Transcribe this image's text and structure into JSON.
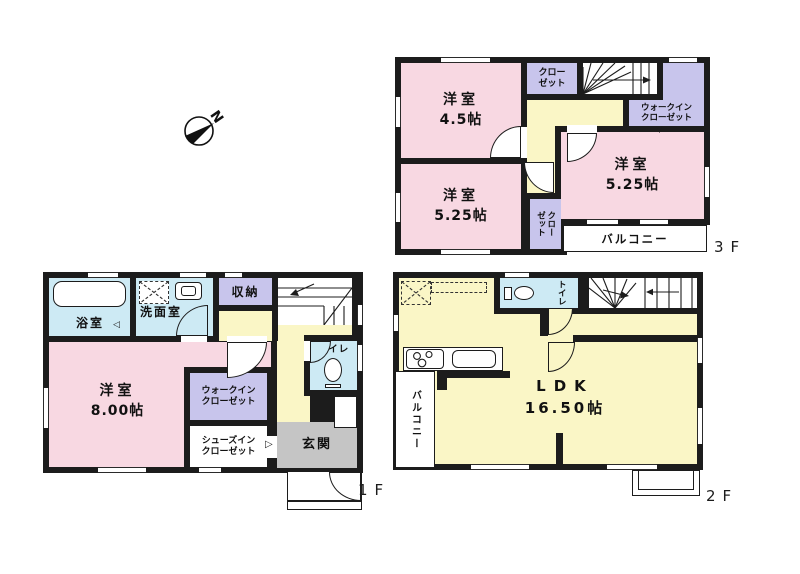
{
  "colors": {
    "room_pink": "#f8d8e2",
    "closet_purple": "#c8c5ec",
    "hall_yellow": "#faf6c6",
    "wet_area_blue": "#cdeaf4",
    "entrance_gray": "#c5c5c5",
    "wall_black": "#1c1c1c"
  },
  "icons": {
    "swing_mark_down": "▽",
    "door_mark_left": "◁",
    "door_mark_right": "▷"
  },
  "compass": {
    "north": "N"
  },
  "floors": {
    "f3": {
      "label": "3F",
      "bedroom45": {
        "name": "洋室",
        "size": "4.5帖"
      },
      "closet_top": {
        "l1": "クロー",
        "l2": "ゼット"
      },
      "wic": {
        "l1": "ウォークイン",
        "l2": "クローゼット"
      },
      "bedroom525_east": {
        "name": "洋室",
        "size": "5.25帖"
      },
      "bedroom525_south": {
        "name": "洋室",
        "size": "5.25帖"
      },
      "closet_vertical": {
        "l1": "クロー",
        "l2": "ゼット"
      },
      "balcony": {
        "name": "バルコニー"
      }
    },
    "f2": {
      "label": "2F",
      "toilet": {
        "name": "トイレ"
      },
      "ldk": {
        "name": "LDK",
        "size": "16.50帖"
      },
      "balcony": {
        "name": "バルコニー"
      }
    },
    "f1": {
      "label": "1F",
      "bath": {
        "name": "浴室"
      },
      "washroom": {
        "name": "洗面室"
      },
      "storage": {
        "name": "収納"
      },
      "toilet": {
        "name": "トイレ"
      },
      "bedroom800": {
        "name": "洋室",
        "size": "8.00帖"
      },
      "wic": {
        "l1": "ウォークイン",
        "l2": "クローゼット"
      },
      "sic": {
        "l1": "シューズイン",
        "l2": "クローゼット"
      },
      "entrance": {
        "name": "玄関"
      }
    }
  }
}
